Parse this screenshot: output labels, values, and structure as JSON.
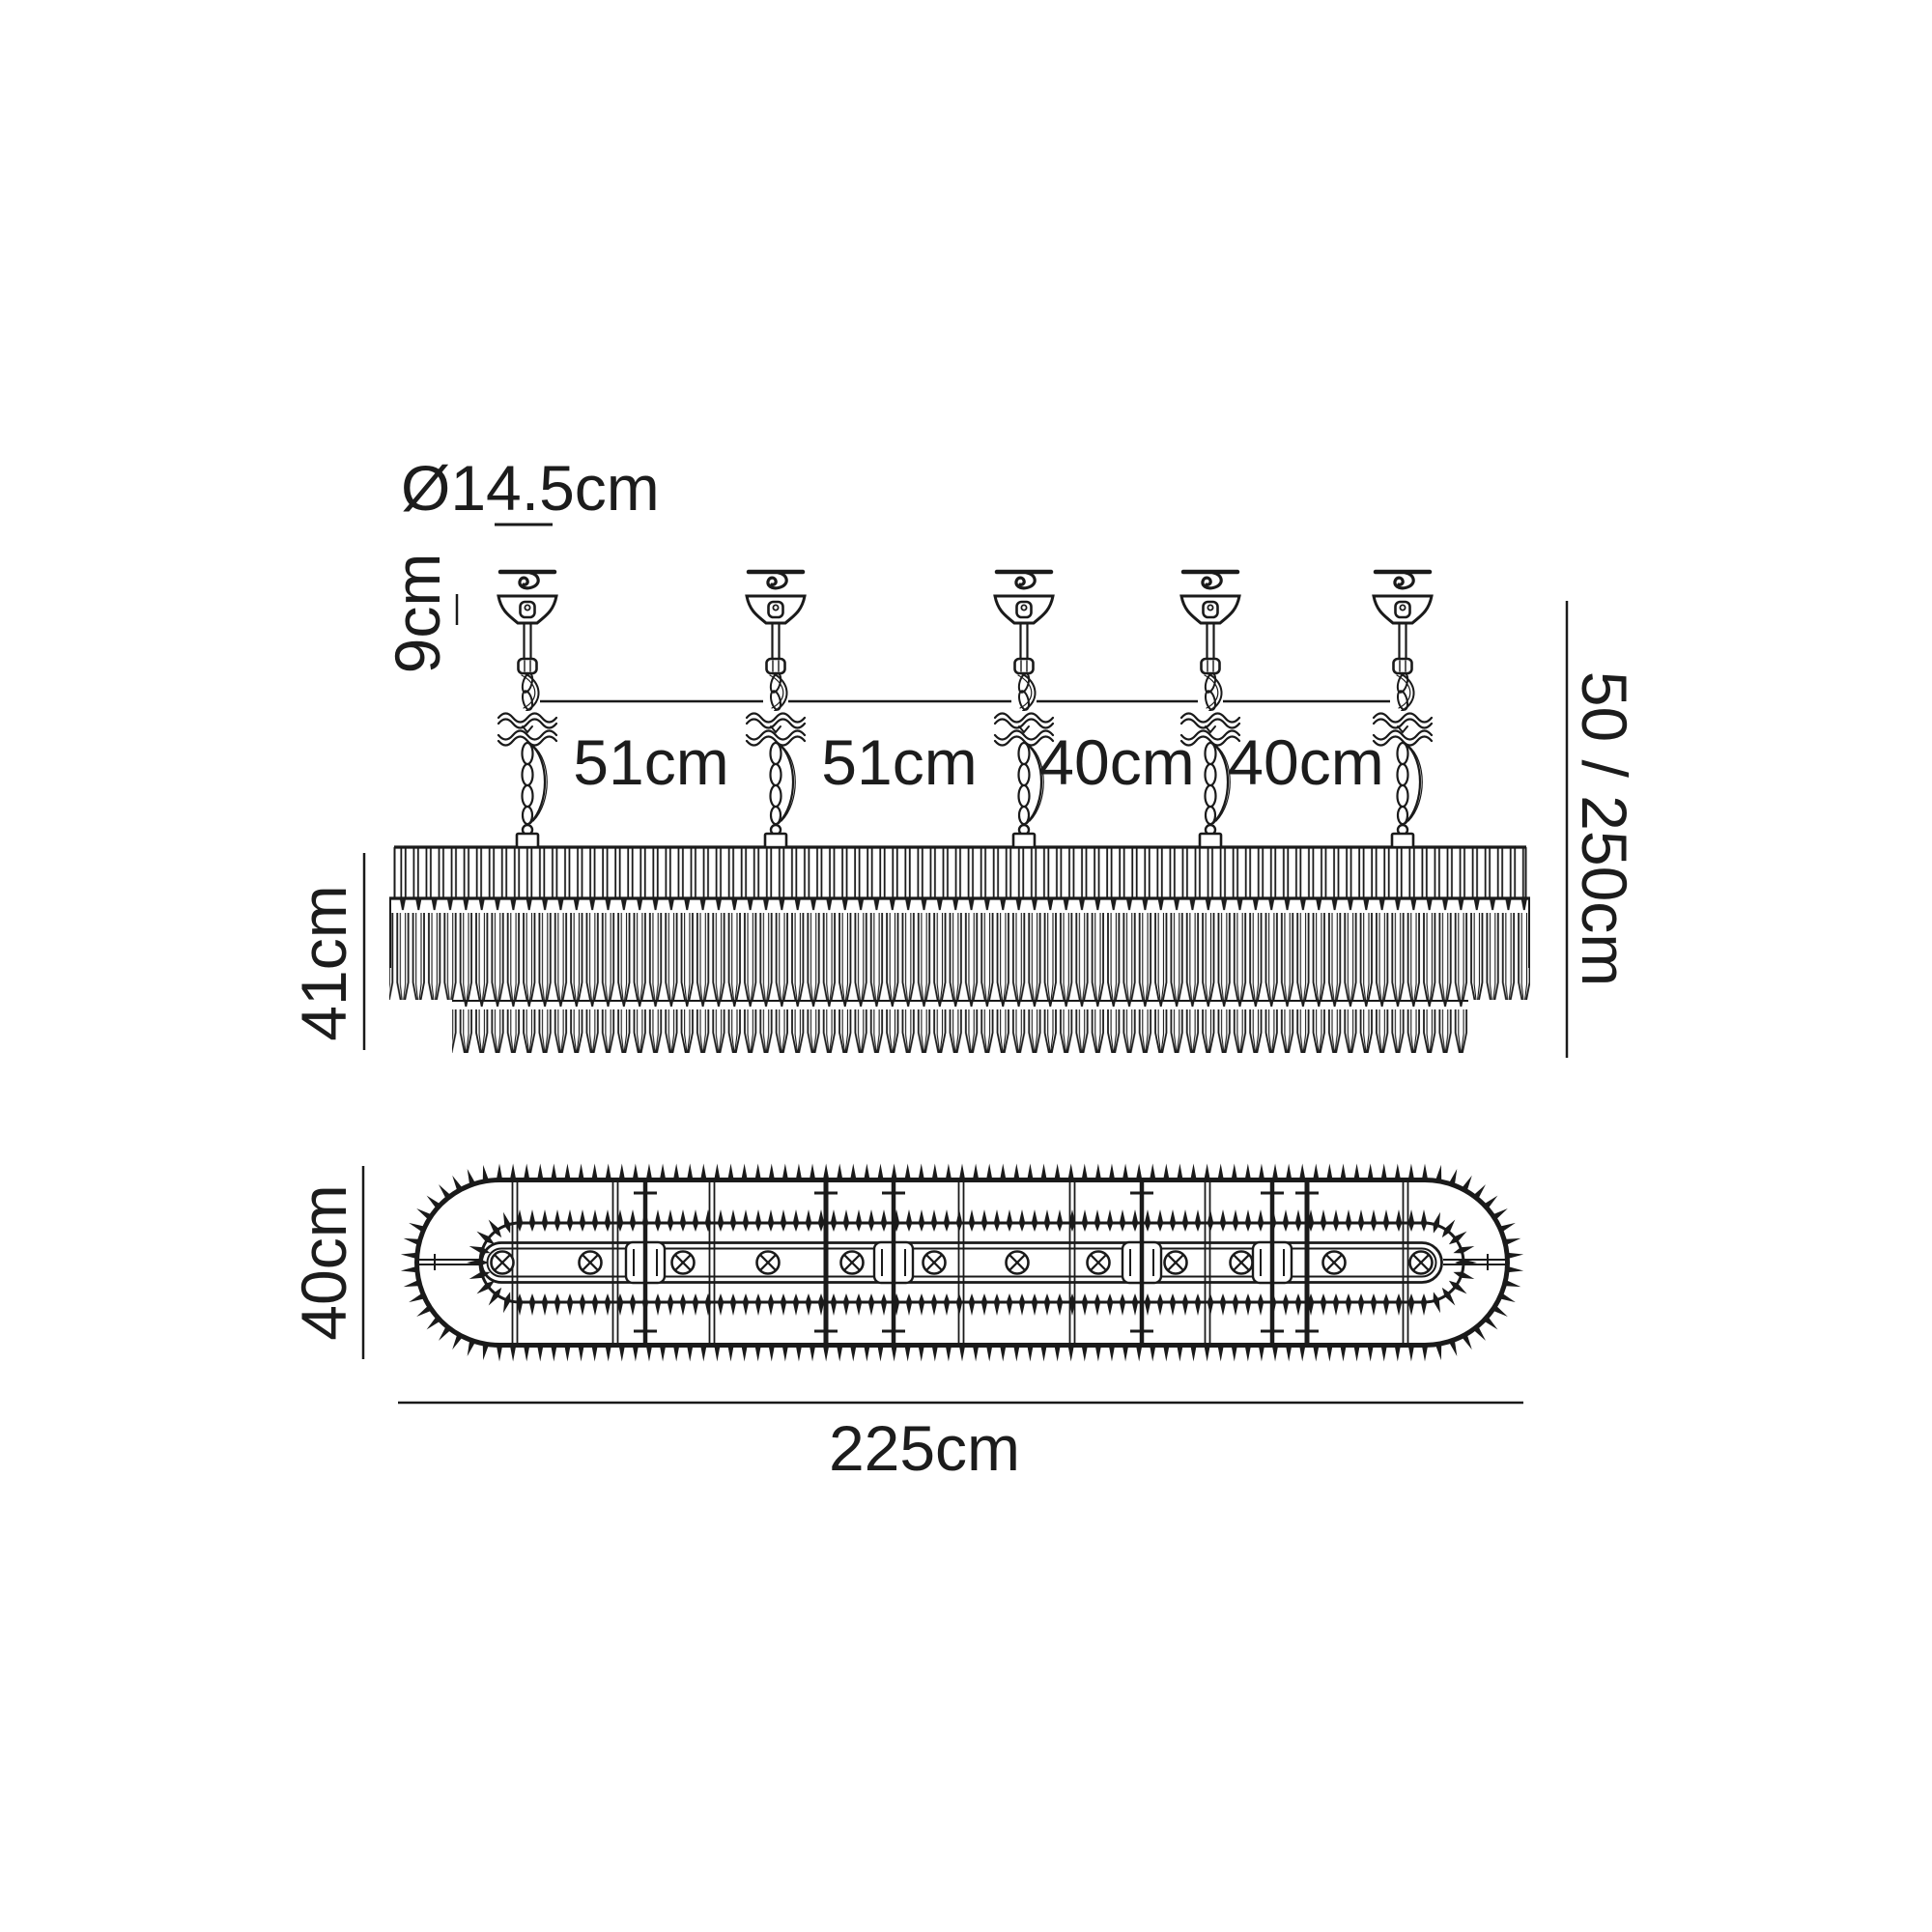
{
  "diagram": {
    "type": "product dimension drawing",
    "product": "linear crystal chandelier with five suspensions",
    "labels": {
      "canopy_diameter": "Ø14.5cm",
      "canopy_height": "9cm",
      "spacing_labels": [
        "51cm",
        "51cm",
        "40cm",
        "40cm"
      ],
      "drop_height": "50 / 250cm",
      "body_height": "41cm",
      "body_depth": "40cm",
      "body_length": "225cm"
    },
    "counts": {
      "suspension_points": 5,
      "lamp_symbols": 12
    },
    "colors": {
      "line": "#1a1a1a",
      "background": "#ffffff"
    }
  }
}
